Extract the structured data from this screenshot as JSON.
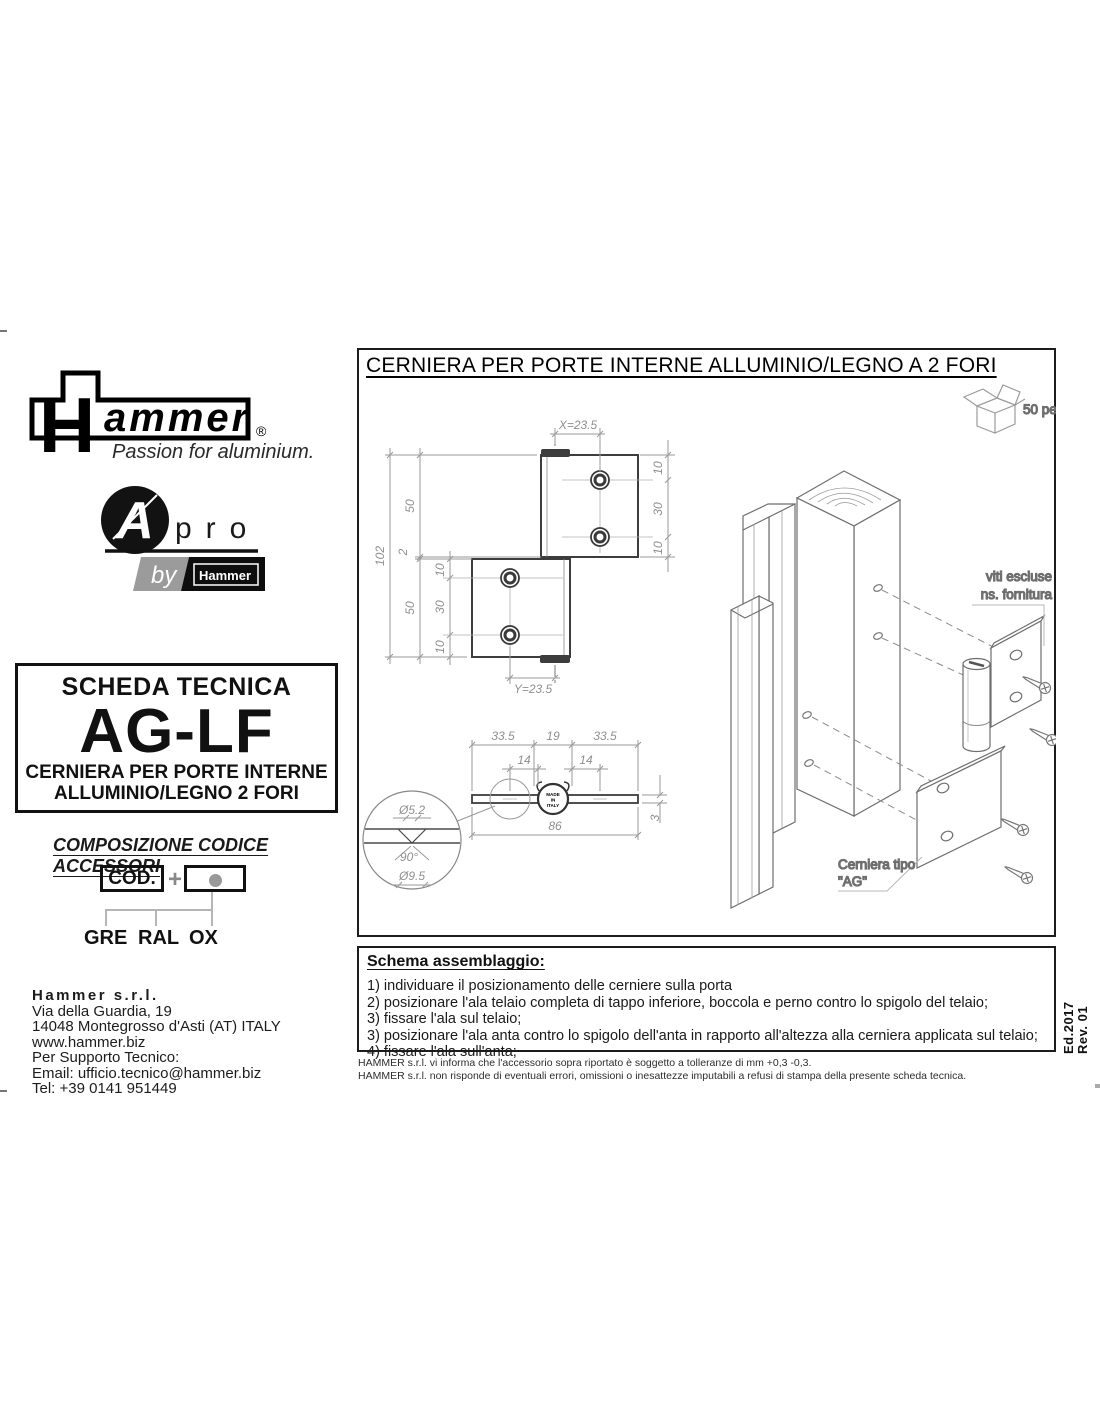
{
  "brand": {
    "hammer_h": "H",
    "hammer_rest": "ammer",
    "registered": "®",
    "tagline": "Passion for aluminium.",
    "apro_a": "A",
    "apro_pro": "pro",
    "apro_by": "by",
    "apro_mini": "Hammer"
  },
  "scheda": {
    "title": "SCHEDA TECNICA",
    "code": "AG-LF",
    "subtitle1": "CERNIERA PER PORTE INTERNE",
    "subtitle2": "ALLUMINIO/LEGNO 2 FORI"
  },
  "composizione": {
    "heading": "COMPOSIZIONE CODICE ACCESSORI",
    "cod_label": "COD.",
    "plus": "+",
    "options": [
      "GRE",
      "RAL",
      "OX"
    ]
  },
  "contact": {
    "company": "Hammer s.r.l.",
    "address1": "Via della Guardia, 19",
    "address2": "14048 Montegrosso d'Asti (AT) ITALY",
    "website": "www.hammer.biz",
    "support": "Per Supporto Tecnico:",
    "email": "Email: ufficio.tecnico@hammer.biz",
    "phone": "Tel: +39 0141 951449"
  },
  "drawing": {
    "title": "CERNIERA PER PORTE INTERNE ALLUMINIO/LEGNO A 2 FORI",
    "qty_label": "50 pezzi",
    "screws_note_1": "viti escluse",
    "screws_note_2": "ns. fornitura",
    "hinge_type_1": "Cerniera tipo",
    "hinge_type_2": "\"AG\"",
    "made_in": {
      "l1": "MADE",
      "l2": "IN",
      "l3": "ITALY"
    },
    "front_dims": {
      "x_offset": "X=23.5",
      "y_offset": "Y=23.5",
      "overall_height": "102",
      "heights": [
        "50",
        "2",
        "50"
      ],
      "upper_hole_spacing": [
        "10",
        "30",
        "10"
      ],
      "lower_hole_spacing": [
        "10",
        "30",
        "10"
      ]
    },
    "plan_dims": {
      "widths": [
        "33.5",
        "19",
        "33.5"
      ],
      "hole_offsets": [
        "14",
        "14"
      ],
      "overall_width": "86",
      "thickness": "3",
      "detail_dims": [
        "Ø5.2",
        "90°",
        "Ø9.5"
      ]
    }
  },
  "schema": {
    "heading": "Schema assemblaggio:",
    "steps": [
      "1) individuare il posizionamento delle cerniere sulla porta",
      "2) posizionare l'ala telaio completa di tappo inferiore, boccola e perno contro lo spigolo del telaio;",
      "3) fissare l'ala sul telaio;",
      "3) posizionare l'ala anta contro lo spigolo dell'anta in rapporto all'altezza alla cerniera applicata sul telaio;",
      "4) fissare l'ala sull'anta;"
    ]
  },
  "footer": {
    "disclaimer_1": "HAMMER s.r.l. vi informa che l'accessorio sopra riportato è soggetto a tolleranze di mm +0,3 -0,3.",
    "disclaimer_2": "HAMMER s.r.l. non risponde di eventuali errori, omissioni o inesattezze imputabili a refusi di stampa della presente scheda tecnica.",
    "edition": "Ed.2017",
    "revision": "Rev. 01"
  }
}
